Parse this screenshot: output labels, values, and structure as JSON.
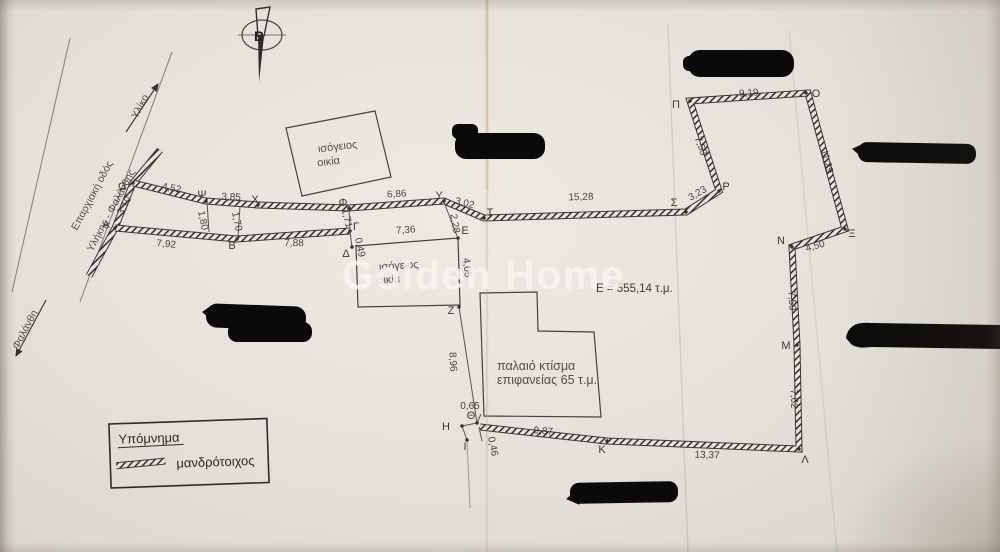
{
  "watermark": "Golden Home",
  "area_label": "Ε = 555,14 τ.μ.",
  "compass": {
    "north": "Β"
  },
  "road": {
    "name_line1": "Επαρχιακή οδός",
    "name_line2": "Υλήκης - Φαλάνθης",
    "dir_top": "Υλίκο",
    "dir_bottom": "Φαλάνθη"
  },
  "buildings": {
    "house1": {
      "line1": "ισόγειος",
      "line2": "οικία"
    },
    "house2": {
      "line1": "ισόγειος",
      "line2": "οικία"
    },
    "old_building": {
      "line1": "παλαιό κτίσμα",
      "line2": "επιφανείας 65 τ.μ."
    }
  },
  "legend": {
    "title": "Υπόμνημα",
    "wall_label": "μανδρότοιχος"
  },
  "points": {
    "alpha": "Α",
    "beta": "Β",
    "gamma": "Γ",
    "delta": "Δ",
    "epsilon": "Ε",
    "zeta": "Ζ",
    "eta": "Η",
    "theta": "Θ",
    "iota": "Ι",
    "kappa": "Κ",
    "lambda": "Λ",
    "mu": "Μ",
    "nu": "Ν",
    "xi": "Ξ",
    "omicron": "Ο",
    "pi": "Π",
    "rho": "Ρ",
    "sigma": "Σ",
    "tau": "Τ",
    "upsilon": "Υ",
    "phi": "Φ",
    "chi": "Χ",
    "psi": "Ψ",
    "omega": "Ω"
  },
  "measurements": {
    "omega_psi": "4,52",
    "psi_chi": "3,85",
    "phi_upsilon": "6,86",
    "upsilon_tau": "3,02",
    "tau_sigma": "15,28",
    "sigma_rho": "3,23",
    "pi_omicron": "9,19",
    "pi_rho": "7,53",
    "omicron_xi": "11,29",
    "xi_nu": "4,50",
    "nu_mu": "7,59",
    "mu_lambda": "7,62",
    "lambda_kappa": "13,37",
    "kappa_theta": "9,87",
    "theta_eta": "0,65",
    "iota_tick": "0,46",
    "zeta_theta": "8,96",
    "epsilon_zeta": "4,05",
    "tau_epsilon": "2,28",
    "delta_epsilon": "7,36",
    "gamma_delta": "0,49",
    "alpha_beta": "7,92",
    "beta_gamma": "7,88",
    "psi_tick": "1,80",
    "chi_tick": "1,70",
    "phi_tick": "1,71",
    "omega_alpha": "3,10"
  },
  "colors": {
    "paper": "#e7e3db",
    "ink": "#2f2d2a",
    "redaction": "#0a0a0a",
    "watermark": "#f8f6f2"
  }
}
